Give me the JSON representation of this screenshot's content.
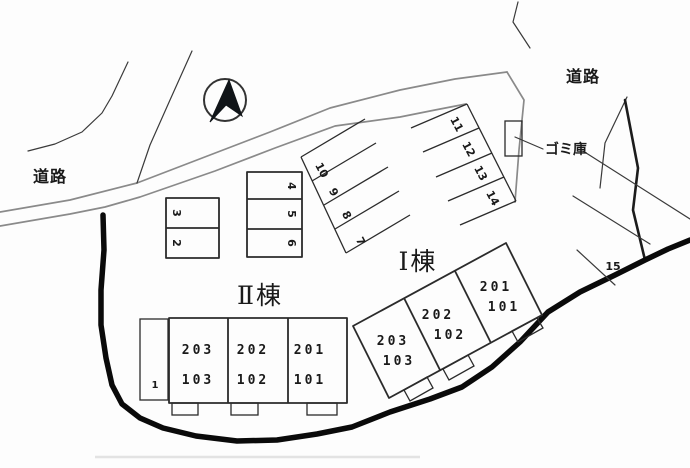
{
  "roads": {
    "left_label": "道路",
    "top_right_label": "道路"
  },
  "garbage_store": {
    "label": "ゴミ庫"
  },
  "buildings": {
    "i": {
      "label": "Ⅰ棟",
      "units": [
        {
          "upper": "203",
          "lower": "103"
        },
        {
          "upper": "202",
          "lower": "102"
        },
        {
          "upper": "201",
          "lower": "101"
        }
      ]
    },
    "ii": {
      "label": "Ⅱ棟",
      "units": [
        {
          "upper": "203",
          "lower": "103"
        },
        {
          "upper": "202",
          "lower": "102"
        },
        {
          "upper": "201",
          "lower": "101"
        }
      ]
    }
  },
  "parking": {
    "spaces": [
      "1",
      "2",
      "3",
      "4",
      "5",
      "6",
      "7",
      "8",
      "9",
      "10",
      "11",
      "12",
      "13",
      "14",
      "15"
    ]
  },
  "compass": {
    "direction": "north"
  },
  "colors": {
    "road": "#8a8a8a",
    "outline": "#2b2b2b",
    "boundary": "#0a0a0a",
    "text": "#1a1a1a"
  }
}
